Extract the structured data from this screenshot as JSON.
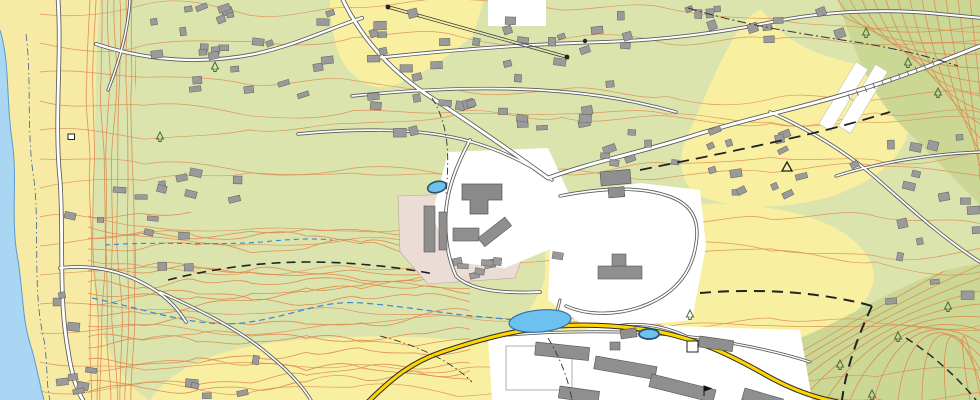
{
  "map": {
    "colors": {
      "water": "#a9d6f2",
      "water_edge": "#5b9bd0",
      "sand": "#f6eaa4",
      "grass": "#dbe4ad",
      "field": "#f8efa0",
      "forest": "#cbd795",
      "contour": "#dd8a4e",
      "road_casing": "#5a5a5a",
      "road_fill": "#ffffff",
      "road_highlight": "#ffd400",
      "road_highlight_casing": "#2b2b2b",
      "building": "#9a9a9a",
      "building_edge": "#5f5f5f",
      "industrial": "#ecdcd6",
      "pond": "#6cc1ee",
      "pond_edge": "#2d6fae",
      "stream": "#3a86d4",
      "pin": "#2a5c40",
      "pin_edge": "#1c3f2c",
      "label": "#1a1a1a",
      "hydro_label": "#1a6fd4",
      "contour_label": "#c87434",
      "spot_red": "#c4615c",
      "tree": "#4a6b38"
    },
    "places": [
      {
        "id": "nad-sleminem",
        "text": "Nad Šlemínem",
        "x": 277,
        "y": 121,
        "rot": 8,
        "cls": "place"
      },
      {
        "id": "nad-malym-vrchem",
        "text": "Nad malým vrchem",
        "x": 822,
        "y": 149,
        "rot": 7,
        "cls": "place-sm"
      },
      {
        "id": "hradistko",
        "text": "Hradištko",
        "x": 673,
        "y": 276,
        "rot": 9,
        "cls": "town"
      },
      {
        "id": "na-vojtesce",
        "text": "Na vojtěšce",
        "x": 779,
        "y": 315,
        "rot": 8,
        "cls": "place"
      },
      {
        "id": "slemin",
        "text": "Šlemín",
        "x": 140,
        "y": 272,
        "rot": 9,
        "cls": "place-sp"
      }
    ],
    "hydro_labels": [
      {
        "id": "pivovarsky-1",
        "text": "Pivovarský",
        "x": 500,
        "y": 351,
        "rot": -7
      },
      {
        "id": "pivovarsky-2",
        "text": "ryb.",
        "x": 506,
        "y": 364,
        "rot": -7
      }
    ],
    "feature_labels": [
      {
        "id": "prum",
        "text": "prům.",
        "x": 427,
        "y": 264,
        "rot": 0
      },
      {
        "id": "sk-upper",
        "text": "šk.",
        "x": 624,
        "y": 196,
        "rot": 0
      },
      {
        "id": "sk-lower",
        "text": "šk.",
        "x": 540,
        "y": 290,
        "rot": 0
      },
      {
        "id": "hriste",
        "text": "hř.",
        "x": 554,
        "y": 393,
        "rot": 0
      },
      {
        "id": "cov",
        "text": "ČOV",
        "x": 653,
        "y": 356,
        "rot": 10
      },
      {
        "id": "zamek",
        "text": "zám",
        "x": 481,
        "y": 203,
        "rot": 0,
        "red": true
      }
    ],
    "elevations": [
      {
        "id": "e-255",
        "text": "255",
        "x": 40,
        "y": 135,
        "rot": -72
      },
      {
        "id": "e-203",
        "text": "203,0",
        "x": 82,
        "y": 143,
        "rot": 0
      },
      {
        "id": "e-256-1",
        "text": "256.1",
        "x": 524,
        "y": 160,
        "rot": 0
      },
      {
        "id": "e-281-7",
        "text": "281.7",
        "x": 516,
        "y": 172,
        "rot": 0
      },
      {
        "id": "e-256-2",
        "text": "256.2",
        "x": 541,
        "y": 181,
        "rot": 0
      },
      {
        "id": "e-283-1",
        "text": "283.1",
        "x": 548,
        "y": 191,
        "rot": 0
      },
      {
        "id": "e-255-2",
        "text": "255.2",
        "x": 492,
        "y": 192,
        "rot": 0
      },
      {
        "id": "e-270-69",
        "text": "270,69",
        "x": 420,
        "y": 371,
        "rot": 0
      },
      {
        "id": "e-274-66",
        "text": "274,66",
        "x": 597,
        "y": 346,
        "rot": 4
      },
      {
        "id": "e-280-35",
        "text": "280,35",
        "x": 731,
        "y": 371,
        "rot": 10
      },
      {
        "id": "e-309-2",
        "text": "309,2",
        "x": 766,
        "y": 182,
        "rot": 10
      },
      {
        "id": "e-56",
        "text": "56",
        "x": 770,
        "y": 163,
        "rot": 8
      }
    ],
    "contour_labels": [
      {
        "id": "c-272",
        "text": "272",
        "x": 199,
        "y": 97,
        "rot": -62
      },
      {
        "id": "c-298",
        "text": "298",
        "x": 497,
        "y": 66,
        "rot": 2
      },
      {
        "id": "c-306",
        "text": "306",
        "x": 905,
        "y": 109,
        "rot": 115
      }
    ],
    "symbols": [
      {
        "id": "parking",
        "text": "P",
        "x": 694,
        "y": 349
      }
    ],
    "marker": {
      "id": "location-pin",
      "x": 492,
      "y": 170
    }
  }
}
